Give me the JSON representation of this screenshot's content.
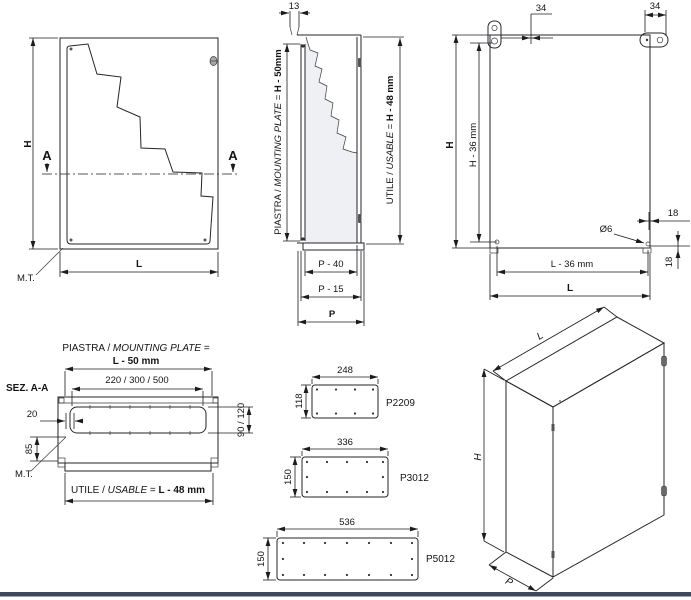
{
  "page": {
    "background": "#ffffff",
    "footer_bar_color": "#3d4a5e"
  },
  "front_view": {
    "dim_height": "H",
    "dim_length": "L",
    "section_marker_left": "A",
    "section_marker_right": "A",
    "ground_label": "M.T."
  },
  "side_view": {
    "dim_bracket": "13",
    "plate_dim": {
      "a": "PIASTRA / ",
      "b": "MOUNTING PLATE",
      "c": " = ",
      "d": "H - 50mm"
    },
    "usable_dim": {
      "a": "UTILE / ",
      "b": "USABLE",
      "c": " = ",
      "d": "H - 48 mm"
    },
    "dim_p40": "P - 40",
    "dim_p15": "P - 15",
    "dim_p": "P"
  },
  "back_view": {
    "dim_offset_left": "34",
    "dim_offset_right": "34",
    "dim_height": "H",
    "dim_height_holes": "H - 36 mm",
    "hole_diameter": "Ø6",
    "dim_hole_edge_top": "18",
    "dim_hole_edge_bottom": "18",
    "dim_length_holes": "L - 36 mm",
    "dim_length": "L"
  },
  "section_view": {
    "title": "SEZ. A-A",
    "plate_dim": {
      "a": "PIASTRA / ",
      "b": "MOUNTING PLATE",
      "c": " ="
    },
    "plate_dim_value": "L - 50 mm",
    "dim_widths": "220 / 300 / 500",
    "dim_gap": "20",
    "dim_85": "85",
    "dim_depth": "90 / 120",
    "ground_label": "M.T.",
    "usable_dim": {
      "a": "UTILE / ",
      "b": "USABLE",
      "c": " = ",
      "d": "L - 48 mm"
    }
  },
  "plates": [
    {
      "model": "P2209",
      "width": "248",
      "height": "118"
    },
    {
      "model": "P3012",
      "width": "336",
      "height": "150"
    },
    {
      "model": "P5012",
      "width": "536",
      "height": "150"
    }
  ],
  "iso_view": {
    "dim_length": "L",
    "dim_height": "H",
    "dim_depth": "P"
  }
}
